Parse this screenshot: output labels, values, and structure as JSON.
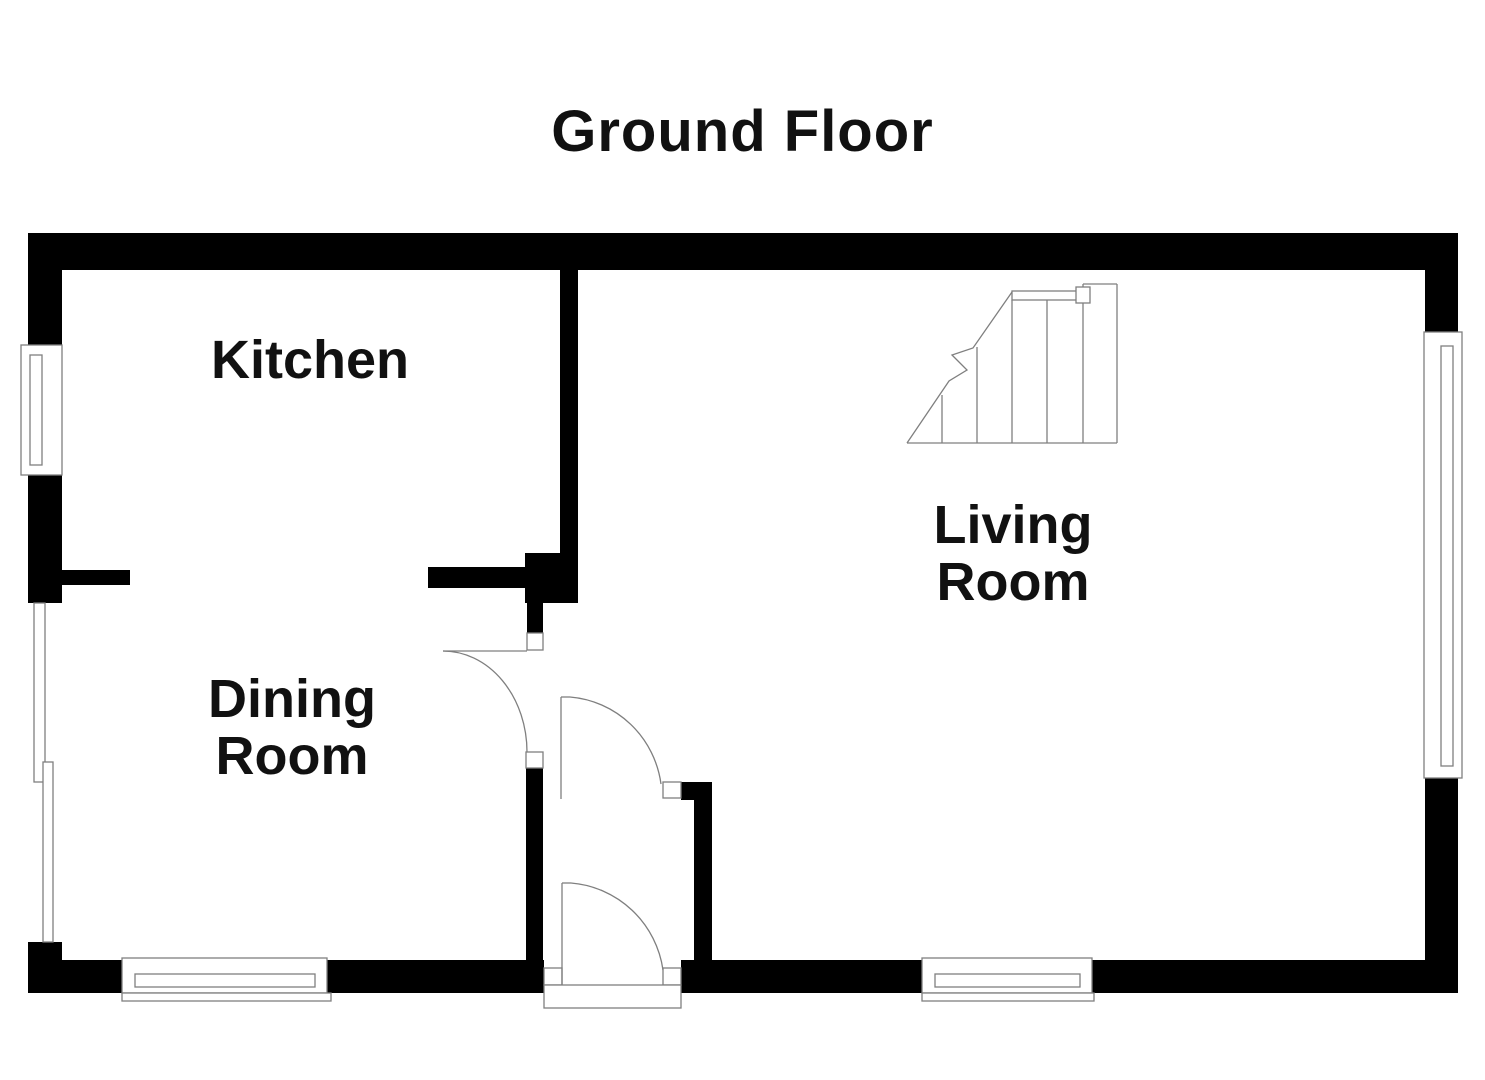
{
  "title": "Ground Floor",
  "rooms": [
    {
      "name": "Kitchen",
      "lines": [
        "Kitchen",
        ""
      ]
    },
    {
      "name": "Living Room",
      "lines": [
        "Living",
        "Room"
      ]
    },
    {
      "name": "Dining Room",
      "lines": [
        "Dining",
        "Room"
      ]
    }
  ],
  "features": {
    "staircase": "staircase with break line",
    "doors": [
      "dining-room-door",
      "hall-living-room-door",
      "front-entrance-door"
    ],
    "windows": [
      "kitchen-left-window",
      "dining-left-window",
      "dining-bottom-window",
      "living-bottom-window",
      "living-right-window"
    ]
  },
  "colors": {
    "wall": "#000000",
    "line": "#7f7f7f",
    "background": "#ffffff",
    "text": "#111111"
  }
}
